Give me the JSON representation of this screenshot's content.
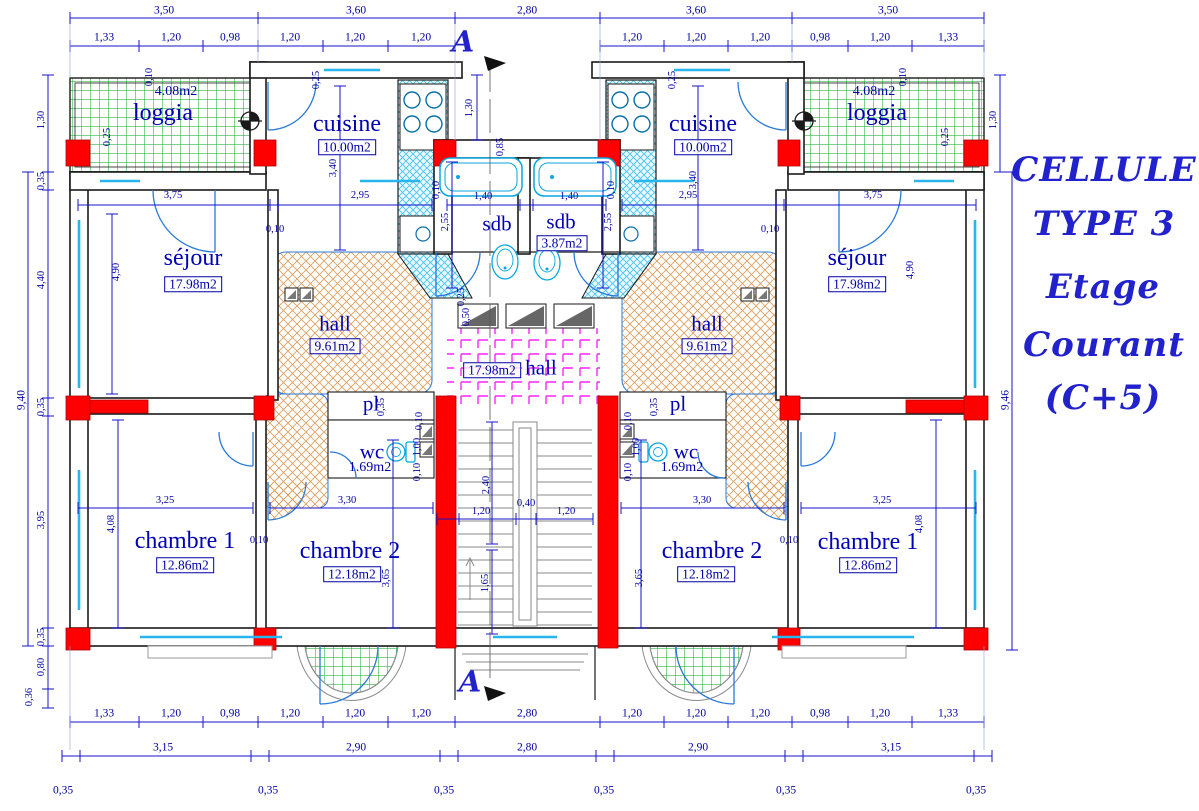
{
  "title": {
    "lines": [
      "CELLULE",
      "TYPE 3",
      "Etage",
      "Courant",
      "(C+5)"
    ]
  },
  "section": {
    "label": "A"
  },
  "rooms": {
    "loggia_l": {
      "name": "loggia",
      "area": "4.08m2"
    },
    "loggia_r": {
      "name": "loggia",
      "area": "4.08m2"
    },
    "cuisine_l": {
      "name": "cuisine",
      "area": "10.00m2"
    },
    "cuisine_r": {
      "name": "cuisine",
      "area": "10.00m2"
    },
    "sejour_l": {
      "name": "séjour",
      "area": "17.98m2"
    },
    "sejour_r": {
      "name": "séjour",
      "area": "17.98m2"
    },
    "hall_l": {
      "name": "hall",
      "area": "9.61m2"
    },
    "hall_r": {
      "name": "hall",
      "area": "9.61m2"
    },
    "hall_c": {
      "name": "hall",
      "area": "17.98m2"
    },
    "sdb_l": {
      "name": "sdb"
    },
    "sdb_r": {
      "name": "sdb",
      "area": "3.87m2"
    },
    "pl_l": {
      "name": "pl"
    },
    "pl_r": {
      "name": "pl"
    },
    "wc_l": {
      "name": "wc",
      "area": "1.69m2"
    },
    "wc_r": {
      "name": "wc",
      "area": "1.69m2"
    },
    "chambre1_l": {
      "name": "chambre 1",
      "area": "12.86m2"
    },
    "chambre1_r": {
      "name": "chambre 1",
      "area": "12.86m2"
    },
    "chambre2_l": {
      "name": "chambre 2",
      "area": "12.18m2"
    },
    "chambre2_r": {
      "name": "chambre 2",
      "area": "12.18m2"
    }
  },
  "dims": {
    "top1": [
      "3,50",
      "3,60",
      "2,80",
      "3,60",
      "3,50"
    ],
    "top2": [
      "1,33",
      "1,20",
      "0,98",
      "1,20",
      "1,20",
      "1,20",
      "1,20",
      "1,20",
      "1,20",
      "0,98",
      "1,20",
      "1,33"
    ],
    "bot1": [
      "1,33",
      "1,20",
      "0,98",
      "1,20",
      "1,20",
      "1,20",
      "2,80",
      "1,20",
      "1,20",
      "1,20",
      "0,98",
      "1,20",
      "1,33"
    ],
    "bot2": [
      "3,15",
      "2,90",
      "2,80",
      "2,90",
      "3,15"
    ],
    "bot3": [
      "0,35",
      "0,35",
      "0,35",
      "0,35",
      "0,35",
      "0,35"
    ],
    "left": [
      "1,30",
      "0,35",
      "4,40",
      "0,35",
      "3,95",
      "0,35",
      "0,80",
      "0,36"
    ],
    "left_total": "9,40",
    "right": [
      "1,30"
    ],
    "right_total": "9,46",
    "v": {
      "d375": "3,75",
      "d295": "2,95",
      "d490": "4,90",
      "d340": "3,40",
      "d140": "1,40",
      "d255": "2,55",
      "d010": "0,10",
      "d025": "0,25",
      "d130": "1,30",
      "d085": "0,85",
      "d050": "0,50",
      "d035": "0,35",
      "d100": "1,00",
      "d325": "3,25",
      "d330": "3,30",
      "d408": "4,08",
      "d365": "3,65",
      "d240": "2,40",
      "d040": "0,40",
      "d120": "1,20",
      "d165": "1,65"
    }
  },
  "colors": {
    "dim_blue": "#1414C8",
    "label_blue": "#0000A6",
    "title_blue": "#2222CC",
    "column_red": "#FF0000",
    "loggia_green": "#33B34A",
    "fixture_cyan": "#0AA6DF",
    "hall_orange": "#DDA05E",
    "tile_magenta": "#FF23FF",
    "stairs_gray": "#8A8A8A"
  }
}
